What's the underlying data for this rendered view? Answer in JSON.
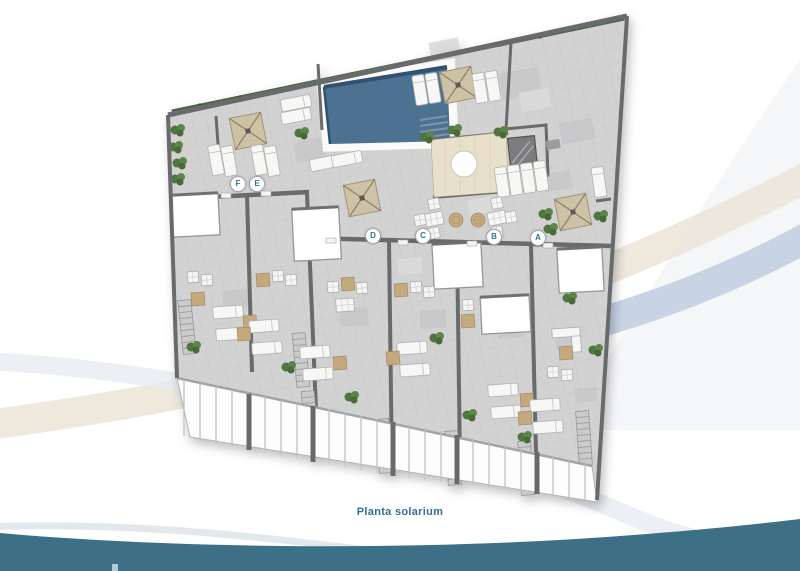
{
  "caption": "Planta solarium",
  "plan": {
    "markers": [
      {
        "letter": "F"
      },
      {
        "letter": "E"
      },
      {
        "letter": "D"
      },
      {
        "letter": "C"
      },
      {
        "letter": "B"
      },
      {
        "letter": "A"
      }
    ],
    "features": [
      "pool",
      "parasol",
      "sun-lounger",
      "hedge",
      "planter-bush",
      "skylight",
      "bar-counter",
      "service-lift",
      "stairs",
      "railing-fence",
      "dining-table",
      "round-table",
      "side-table",
      "lounge-chair"
    ]
  },
  "colors": {
    "teal_wave": "#3d7086",
    "caption_text": "#2f7294",
    "marker_letter": "#2c7596",
    "pool_water": "#4e7190",
    "floor": "#d2d2d3",
    "wall": "#696a6c",
    "parasol": "#cec2a6",
    "plant": "#567c43",
    "furniture_tan": "#c3a97d",
    "bar_floor": "#e9e0cb",
    "swoosh_blue": "#c8d3e3",
    "swoosh_tan": "#ece5d9",
    "swoosh_silver": "#e7ebf0"
  }
}
